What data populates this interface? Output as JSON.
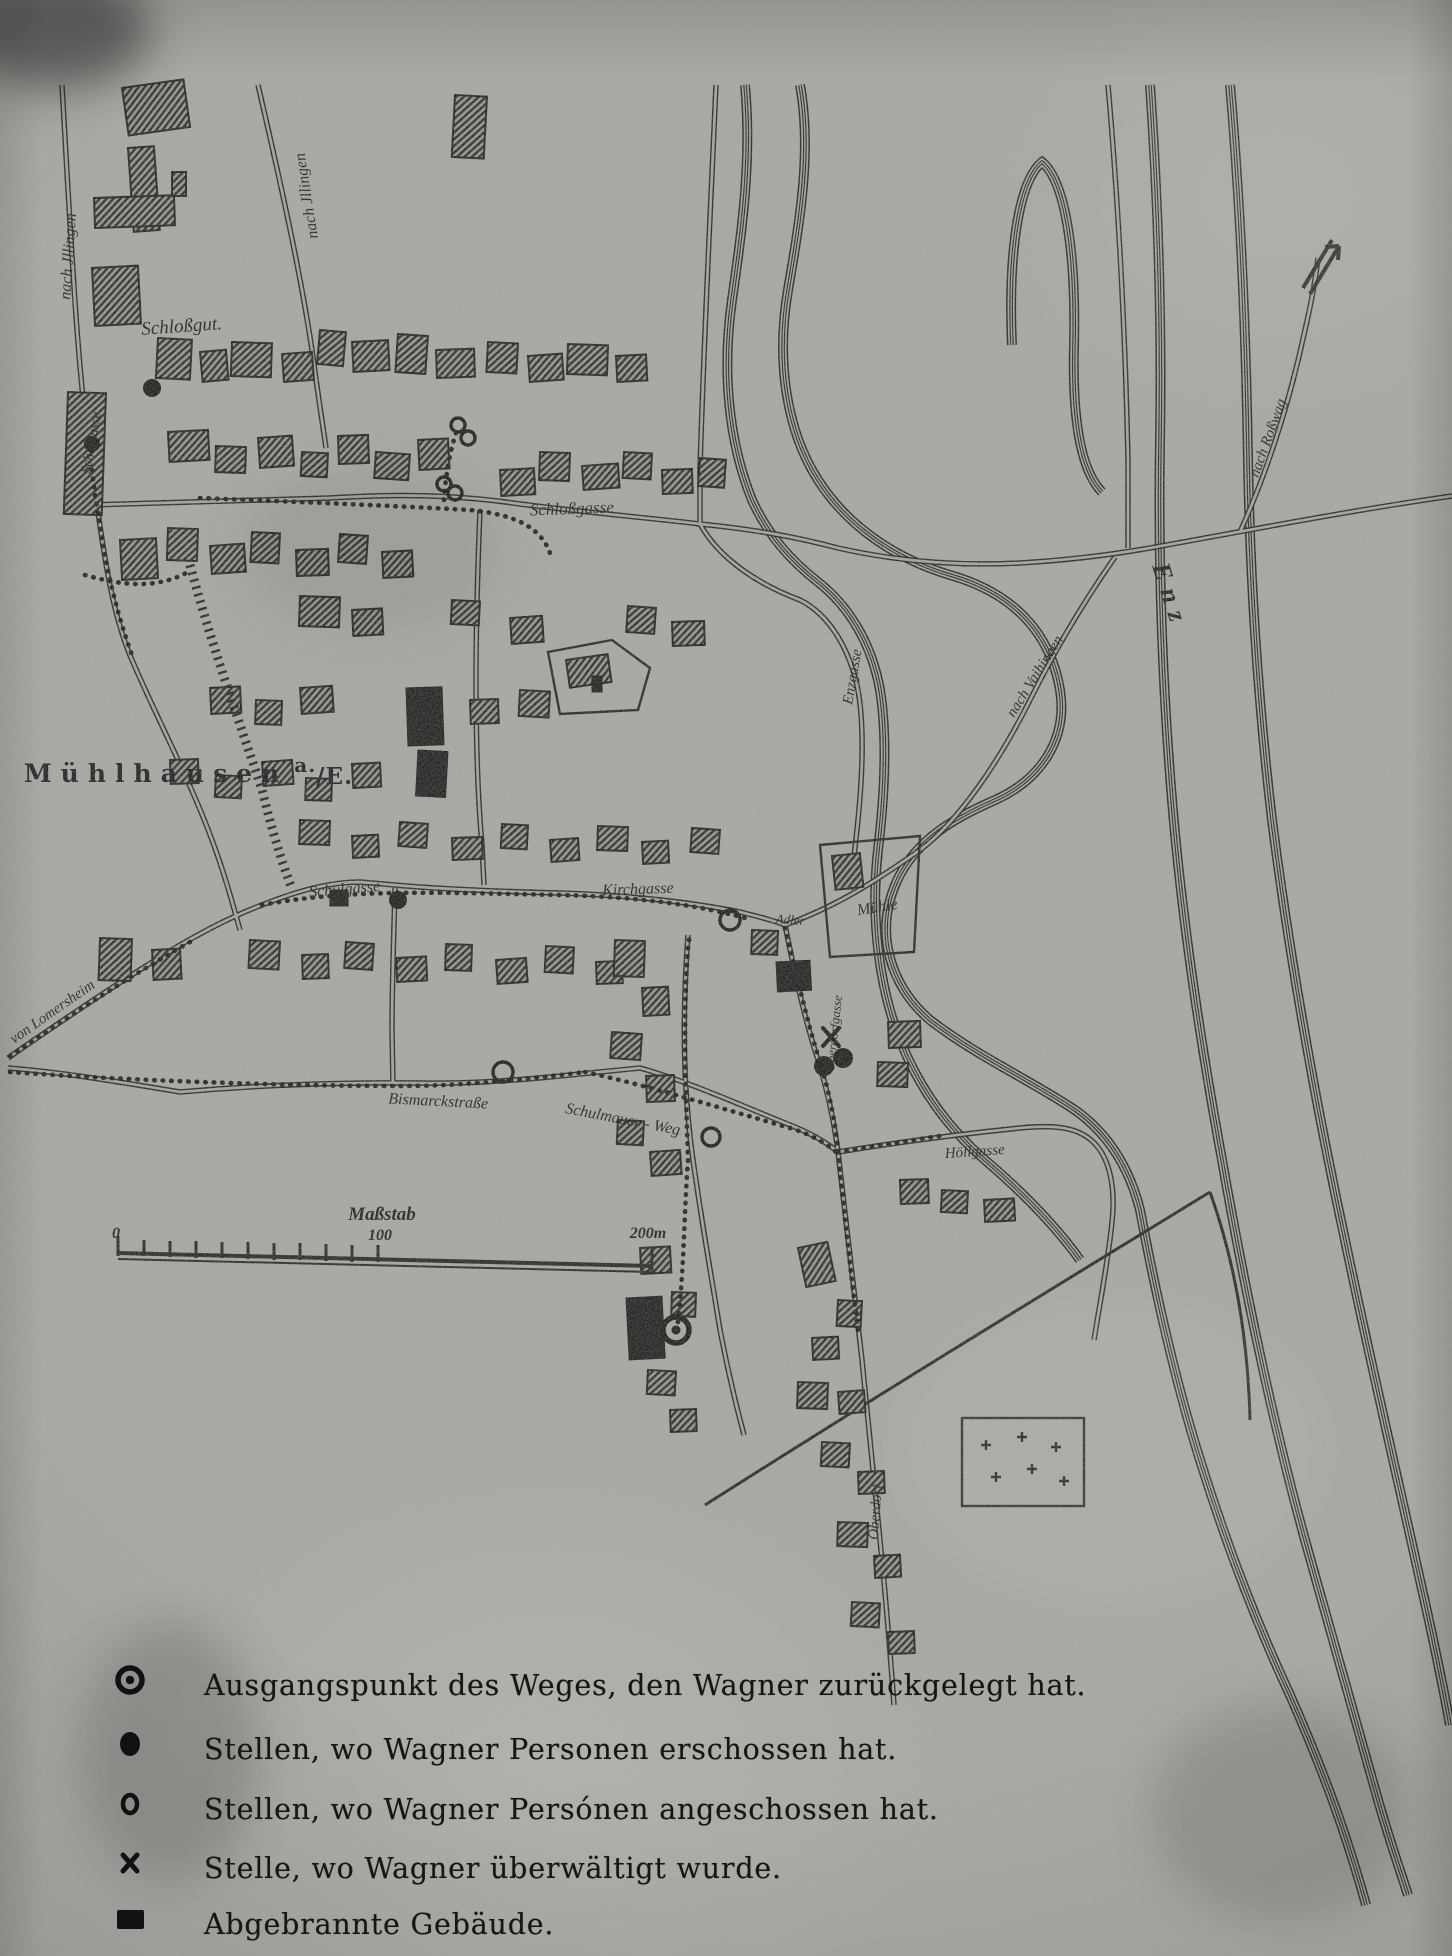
{
  "title": {
    "name": "Mühlhausen",
    "sup": "a.",
    "sub": "/E."
  },
  "labels": {
    "schlossgut": "Schloßgut.",
    "schlossgasse": "Schloßgasse",
    "schulgasse": "Schulgasse",
    "kirchgasse": "Kirchgasse",
    "enzgasse": "Enzgasse",
    "adler": "Adler",
    "muehle": "Mühle",
    "enz": "Enz",
    "bismarckstrasse": "Bismarckstraße",
    "schulmauer_weg": "Schulmauer - Weg",
    "hoellgasse": "Höllgasse",
    "oberdorfgasse": "Oberdorfgasse",
    "oberdorf": "Oberdorf",
    "schafgasse": "Schafgasse",
    "nach_illingen_1": "nach Jllingen",
    "nach_illingen_2": "nach Jllingen",
    "nach_rosswag": "nach Roßwag",
    "nach_vaihingen": "nach Vaihingen",
    "von_lomersheim": "von Lomersheim"
  },
  "scale": {
    "title": "Maßstab",
    "tick_0": "0",
    "tick_100": "100",
    "tick_200": "200m"
  },
  "legend": {
    "items": [
      {
        "symbol": "start-point-icon",
        "text": "Ausgangspunkt des Weges, den Wagner zurückgelegt hat."
      },
      {
        "symbol": "shot-dead-icon",
        "text": "Stellen, wo Wagner Personen erschossen hat."
      },
      {
        "symbol": "shot-wounded-icon",
        "text": "Stellen, wo Wagner Persónen angeschossen hat."
      },
      {
        "symbol": "overpowered-icon",
        "text": "Stelle, wo Wagner überwältigt wurde."
      },
      {
        "symbol": "burned-building-icon",
        "text": "Abgebrannte Gebäude."
      }
    ]
  },
  "colors": {
    "paper": "#a6a6a2",
    "ink": "#1b1b19"
  }
}
